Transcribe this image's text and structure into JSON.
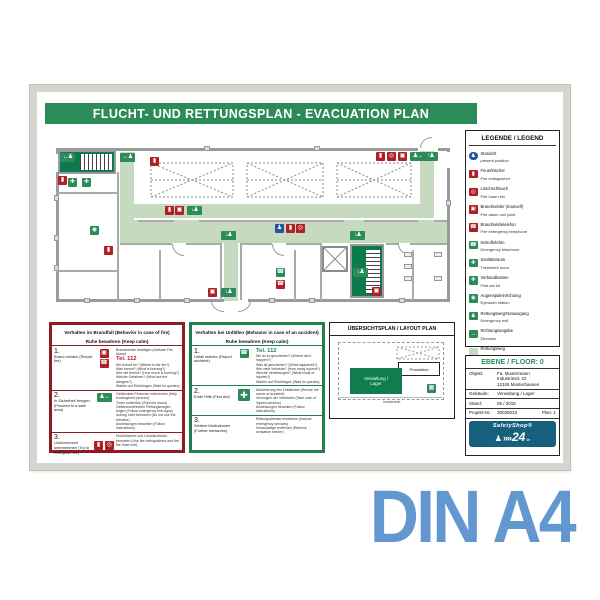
{
  "caption": "DIN A4",
  "title": "FLUCHT- UND RETTUNGSPLAN - EVACUATION PLAN",
  "colors": {
    "safety_green": "#2b8c5a",
    "dark_green": "#0c7a4c",
    "route_green": "#c5dabf",
    "safety_red": "#b01f24",
    "box_red": "#8f1b1e",
    "standort_blue": "#1f55a0",
    "logo_blue": "#16607d",
    "caption_blue": "#6397cf",
    "frame_silver": "#d6d6d0"
  },
  "icons": {
    "standort": "♟",
    "extinguisher": "▮",
    "hose_reel": "◎",
    "call_point": "▣",
    "phone": "☎",
    "cross": "✚",
    "eyewash": "◉",
    "assembly": "▦",
    "direction": "→",
    "exit_left": "←♟",
    "exit_right": "♟→",
    "exit_down": "↓♟",
    "exit_up": "↑♟"
  },
  "legend": {
    "title": "LEGENDE / LEGEND",
    "items": [
      {
        "de": "Standort",
        "en": "present position"
      },
      {
        "de": "Feuerlöscher",
        "en": "Fire extinguisher"
      },
      {
        "de": "Löschschlauch",
        "en": "Fire hose reel"
      },
      {
        "de": "Brandmelder (manuell)",
        "en": "Fire alarm call point"
      },
      {
        "de": "Brandmeldetelefon",
        "en": "Fire emergency telephone"
      },
      {
        "de": "Notruftelefon",
        "en": "Emergency telephone"
      },
      {
        "de": "Sanitätsraum",
        "en": "Treatment room"
      },
      {
        "de": "Verbandkasten",
        "en": "First aid kit"
      },
      {
        "de": "Augenspüleinrichtung",
        "en": "Eyewash station"
      },
      {
        "de": "Rettungsweg/Notausgang",
        "en": "Emergency exit"
      },
      {
        "de": "Richtungsangabe",
        "en": "Direction"
      },
      {
        "de": "Rettungsweg",
        "en": "Emergency route"
      },
      {
        "de": "Treppenraum",
        "en": "Stair space"
      },
      {
        "de": "Sammelstelle",
        "en": "Evacuation assembly point"
      }
    ]
  },
  "fire_box": {
    "title1": "Verhalten im Brandfall (Behavior in case of fire)",
    "title2": "Ruhe bewahren (Keep calm)",
    "sections": [
      {
        "num": "1.",
        "label": "Brand melden (Report fire)",
        "intro": "Brandmelder betätigen (Activate Fire Alarm)",
        "tel": "Tel. 112",
        "lines": [
          "Wo brennt es? (Where is the fire?)",
          "Was brennt? (What is burning?)",
          "Wie viel brennt? (How much is burning?)",
          "Welche Gefahren? (What are the dangers?)",
          "Warten auf Rückfragen (Wait for queries)"
        ]
      },
      {
        "num": "2.",
        "label": "In Sicherheit bringen (Proceed to a safe area)",
        "lines": [
          "Gefährdete Personen mitnehmen (Help endangered persons)",
          "Türen schließen (Shut the doors)",
          "Gekennzeichneten Rettungswegen folgen (Follow emergency exit signs)",
          "Aufzug nicht benutzen (Do not use the elevator)",
          "Anweisungen beachten (Follow instructions)"
        ]
      },
      {
        "num": "3.",
        "label": "Löschversuch unternehmen (Try to extinguish fire)",
        "lines": [
          "Feuerlöscher und Löschschlauch benutzen (Use fire extinguishers and the fire hose reel)"
        ]
      }
    ]
  },
  "accident_box": {
    "title1": "Verhalten bei Unfällen (Behavior in case of an accident)",
    "title2": "Ruhe bewahren (Keep calm)",
    "sections": [
      {
        "num": "1.",
        "label": "Unfall melden (Report accident)",
        "tel": "Tel. 112",
        "lines": [
          "Wo ist es geschehen? (Where did it happen?)",
          "Was ist geschehen? (What happened?)",
          "Wie viele Verletzte? (How many injured?)",
          "Welche Verletzungen? (What kinds of injuries?)",
          "Warten auf Rückfragen (Wait for queries)"
        ]
      },
      {
        "num": "2.",
        "label": "Erste Hilfe (First Aid)",
        "lines": [
          "Absicherung des Unfallortes (Secure the scene of accident)",
          "Versorgen der Verletzten (Take care of injured persons)",
          "Anweisungen beachten (Follow instructions)"
        ]
      },
      {
        "num": "3.",
        "label": "Weitere Maßnahmen (Further measures)",
        "lines": [
          "Rettungsdienste einweisen (Instruct emergency services)",
          "Schaulustige entfernen (Remove sensation seeker)"
        ]
      }
    ]
  },
  "layout_plan": {
    "title": "ÜBERSICHTSPLAN / LAYOUT PLAN",
    "production": "Produktion",
    "admin_1": "Verwaltung /",
    "admin_2": "Lager",
    "street": "Industriestr."
  },
  "info": {
    "header": "EBENE / FLOOR: 0",
    "objekt_label": "Objekt:",
    "objekt_1": "Fa. Mustermann",
    "objekt_2": "Industriestr. 22",
    "objekt_3": "12345 Musterhausen",
    "gebaeude_label": "Gebäude:",
    "gebaeude": "Verwaltung / Lager",
    "stand_label": "Stand:",
    "stand": "05 / 2015",
    "projekt_label": "Projekt-Nr.:",
    "projekt": "30026033",
    "plan": "Plan: 1",
    "logo": {
      "brand": "SafetyShop",
      "reg": "®",
      "arrows": "»»",
      "number": "24",
      "tld": "de"
    }
  }
}
